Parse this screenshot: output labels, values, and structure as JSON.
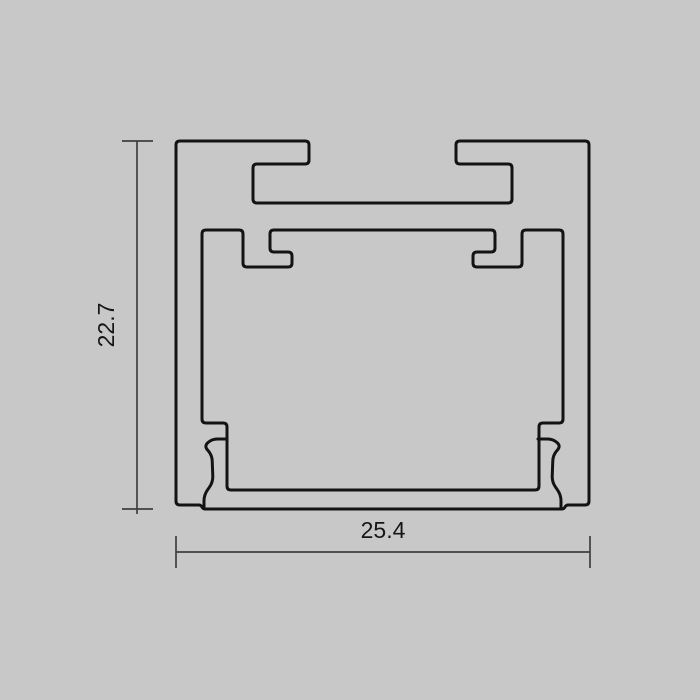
{
  "canvas": {
    "width": 700,
    "height": 700,
    "background": "#c8c8c8"
  },
  "drawing": {
    "description": "aluminium-profile-cross-section",
    "stroke_color": "#131313",
    "stroke_width": 3,
    "corner_radius": 4,
    "outer_contour": [
      [
        176,
        141
      ],
      [
        309,
        141
      ],
      [
        309,
        164
      ],
      [
        253,
        164
      ],
      [
        253,
        203
      ],
      [
        512,
        203
      ],
      [
        512,
        164
      ],
      [
        456,
        164
      ],
      [
        456,
        141
      ],
      [
        589,
        141
      ],
      [
        589,
        505
      ],
      [
        566,
        505
      ],
      [
        564,
        509
      ],
      [
        203,
        509
      ],
      [
        201,
        505
      ],
      [
        176,
        505
      ]
    ],
    "inner_contour": [
      [
        202,
        230
      ],
      [
        243,
        230
      ],
      [
        243,
        267
      ],
      [
        292,
        267
      ],
      [
        292,
        252
      ],
      [
        270,
        252
      ],
      [
        270,
        230
      ],
      [
        495,
        230
      ],
      [
        495,
        252
      ],
      [
        473,
        252
      ],
      [
        473,
        267
      ],
      [
        522,
        267
      ],
      [
        522,
        230
      ],
      [
        563,
        230
      ],
      [
        563,
        423
      ],
      [
        539,
        423
      ],
      [
        539,
        490
      ],
      [
        227,
        490
      ],
      [
        227,
        423
      ],
      [
        202,
        423
      ]
    ],
    "screw_finger_left": [
      [
        227,
        439
      ],
      [
        212,
        439
      ],
      [
        204,
        446
      ],
      [
        212,
        455
      ],
      [
        213,
        482
      ],
      [
        204,
        495
      ],
      [
        204,
        508
      ]
    ],
    "screw_finger_right": [
      [
        538,
        439
      ],
      [
        553,
        439
      ],
      [
        561,
        446
      ],
      [
        553,
        455
      ],
      [
        552,
        482
      ],
      [
        561,
        495
      ],
      [
        561,
        508
      ]
    ],
    "finger_radius": 6
  },
  "dimensions": {
    "color": "#3f3f3f",
    "stroke_width": 1.7,
    "height": {
      "label": "22.7",
      "line": {
        "x": 137,
        "y1": 141,
        "y2": 514
      },
      "ticks": [
        {
          "x1": 122,
          "x2": 153,
          "y1": 141,
          "y2": 141
        },
        {
          "x1": 122,
          "x2": 153,
          "y1": 509,
          "y2": 509
        }
      ],
      "label_center": {
        "x": 106,
        "y": 325
      }
    },
    "width": {
      "label": "25.4",
      "line": {
        "x1": 176,
        "x2": 590,
        "y": 552
      },
      "ticks": [
        {
          "x1": 176,
          "x2": 176,
          "y1": 536,
          "y2": 568
        },
        {
          "x1": 590,
          "x2": 590,
          "y1": 536,
          "y2": 568
        }
      ],
      "label_center": {
        "x": 383,
        "y": 530
      }
    }
  }
}
